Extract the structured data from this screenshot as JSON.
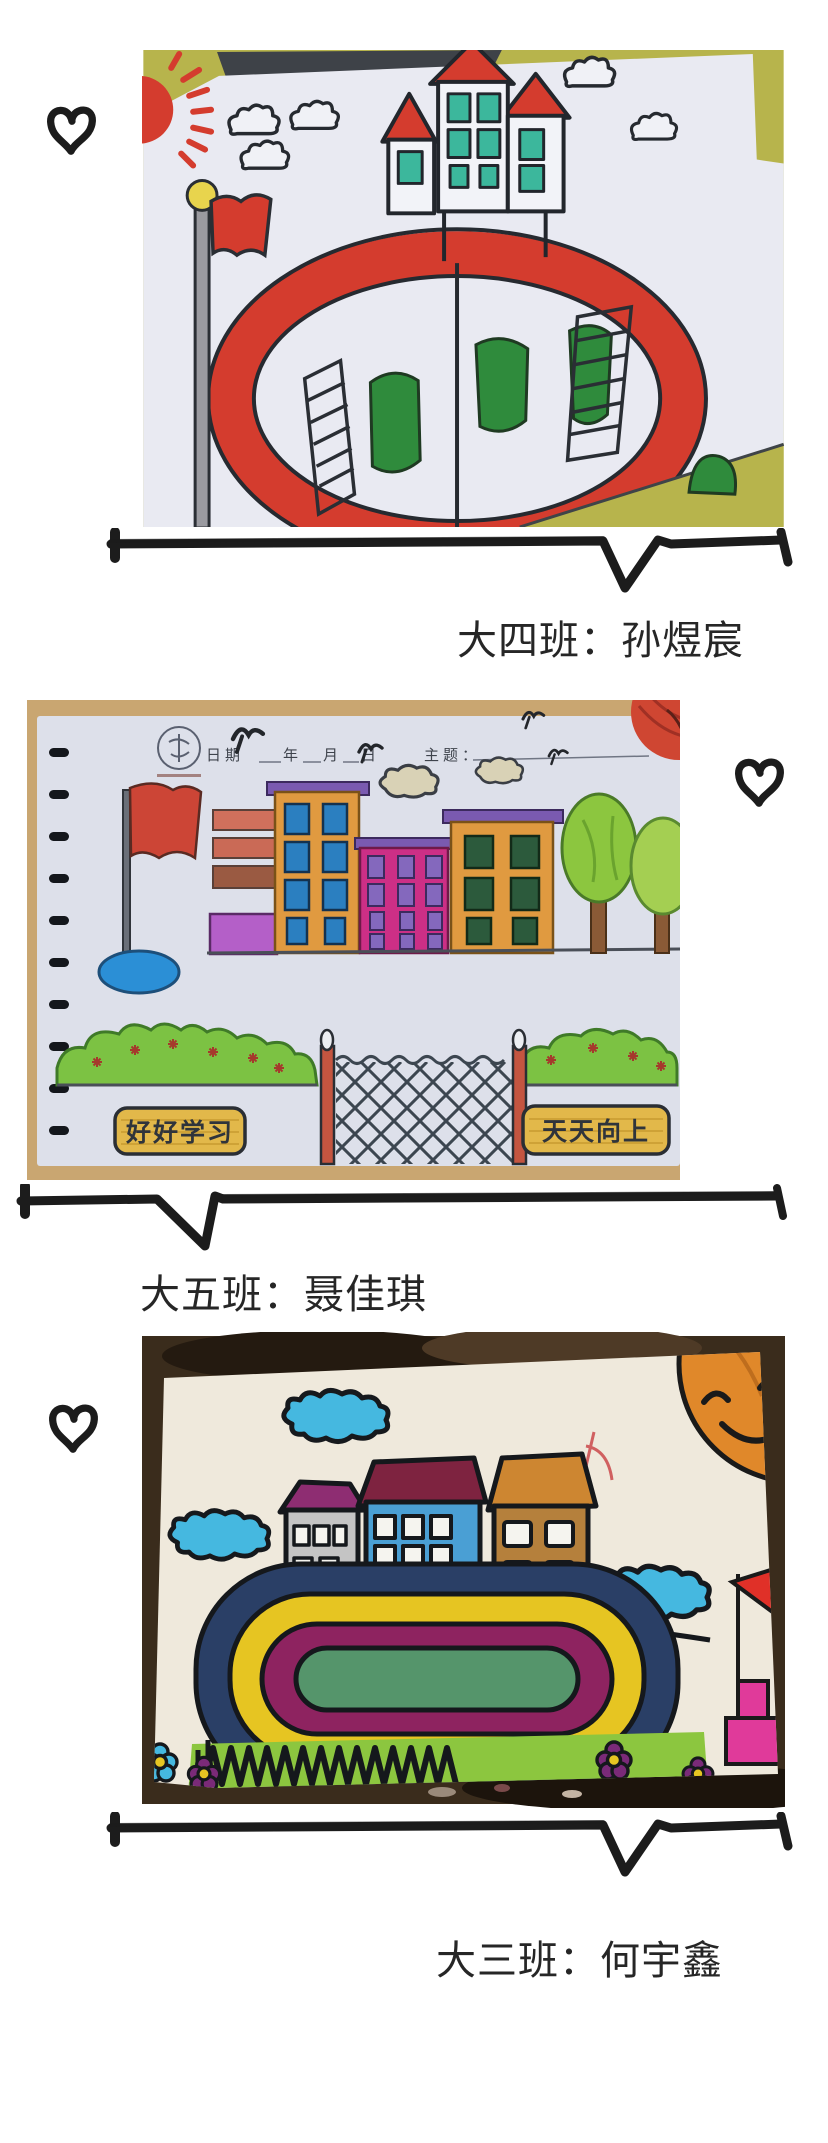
{
  "captions": {
    "first": "大四班：孙煜宸",
    "second": "大五班：聂佳琪",
    "third": "大三班：何宇鑫"
  },
  "notebook": {
    "date_label": "日期",
    "year_label": "年",
    "month_label": "月",
    "day_label": "日",
    "topic_label": "主题："
  },
  "signs": {
    "left": "好好学习",
    "right": "天天向上"
  },
  "palette": {
    "ink": "#1c1c1c",
    "caption_text": "#262626",
    "marker_red": "#d43c2e",
    "window_teal": "#3cb79c",
    "bush_green": "#2f8b3c",
    "building_orange": "#e09a40",
    "building_magenta": "#cc2f86",
    "window_blue": "#2b7fc0",
    "sign_yellow": "#e2b84a",
    "track_navy": "#2a3f66",
    "track_yellow": "#e6c522",
    "track_magenta": "#8e2360",
    "track_green": "#55956b",
    "cloud_blue": "#45b8e0",
    "sun_orange": "#e0882a",
    "grass_green": "#8cc63f"
  }
}
